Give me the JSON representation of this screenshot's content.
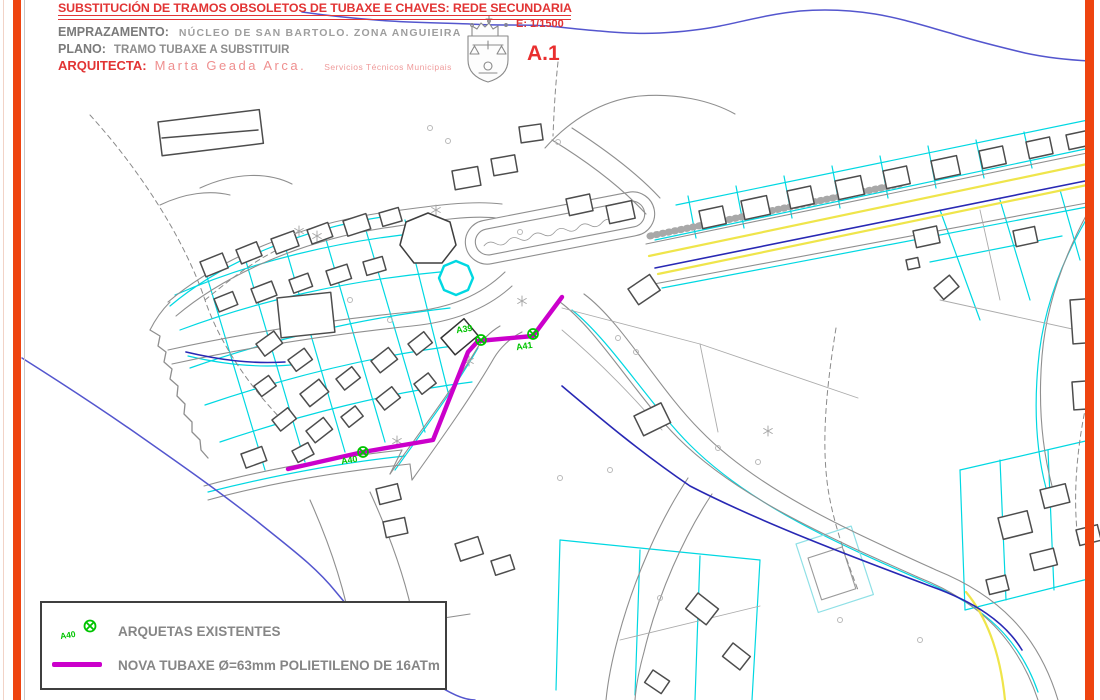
{
  "title_block": {
    "title": "SUBSTITUCIÓN DE TRAMOS OBSOLETOS DE TUBAXE E CHAVES: REDE SECUNDARIA",
    "emprazamento_label": "EMPRAZAMENTO:",
    "emprazamento_value": "NÚCLEO DE SAN BARTOLO. ZONA ANGUIEIRA",
    "plano_label": "PLANO:",
    "plano_value": "TRAMO TUBAXE A SUBSTITUIR",
    "arquitecta_label": "ARQUITECTA:",
    "arquitecta_value": "Marta Geada Arca.",
    "arquitecta_note": "Servicios Técnicos Municipais",
    "scale": "E: 1/1500",
    "sheet": "A.1"
  },
  "map": {
    "markers": [
      {
        "id": "A39"
      },
      {
        "id": "A41"
      },
      {
        "id": "A40"
      }
    ]
  },
  "legend": {
    "arqueta_symbol_label": "A40",
    "arquetas_label": "ARQUETAS EXISTENTES",
    "tubaxe_label": "NOVA TUBAXE Ø=63mm POLIETILENO DE 16ATm"
  },
  "colors": {
    "frame_orange": "#ee4410",
    "parcel_cyan": "#00d8e2",
    "new_pipe_magenta": "#cb00cb",
    "existing_pipe_blue": "#2828b4",
    "boundary_blue": "#5456ce",
    "arqueta_green": "#00c400",
    "road_yellow": "#efe54b",
    "title_red": "#e23434"
  }
}
